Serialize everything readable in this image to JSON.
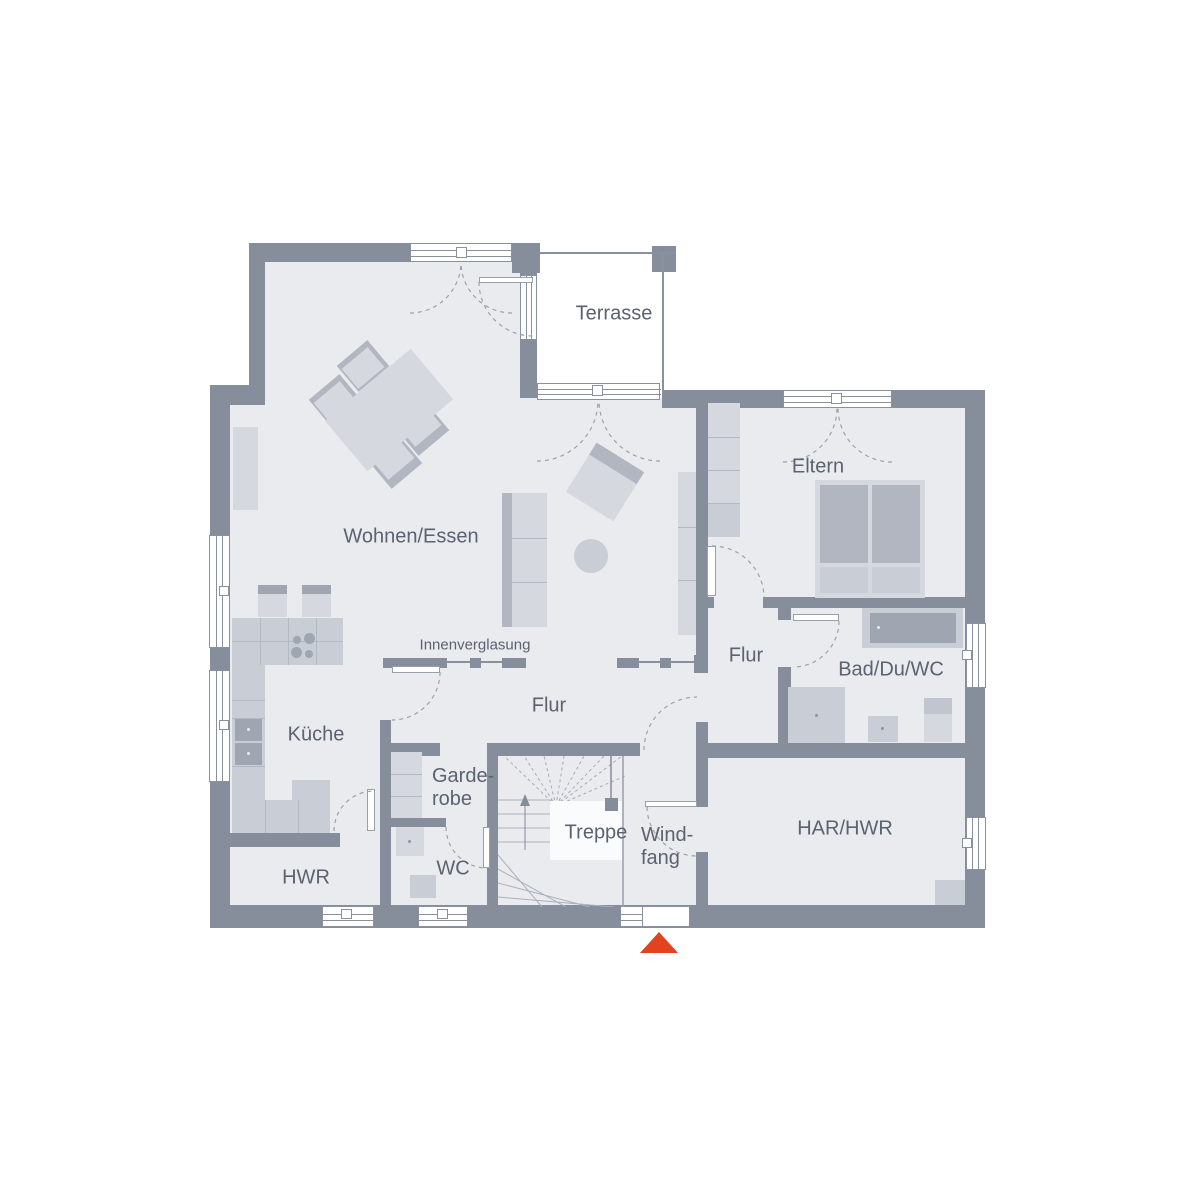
{
  "plan": {
    "rooms": {
      "wohnen_essen": "Wohnen/Essen",
      "terrasse": "Terrasse",
      "eltern": "Eltern",
      "flur_rechts": "Flur",
      "bad_du_wc": "Bad/Du/WC",
      "kueche": "Küche",
      "flur_mitte": "Flur",
      "garderobe": "Garde-\nrobe",
      "hwr": "HWR",
      "wc": "WC",
      "treppe": "Treppe",
      "windfang": "Wind-\nfang",
      "har_hwr": "HAR/HWR"
    },
    "annotations": {
      "innenverglasung": "Innenverglasung"
    },
    "colors": {
      "wall": "#878e9b",
      "floor": "#e9ebef",
      "furniture": "#d5d8df",
      "furniture_mid": "#c9cdd5",
      "furniture_dark": "#b1b6c1",
      "appliance": "#9fa5b1",
      "line": "#8a919e",
      "label_text": "#5b6270",
      "terrace_floor": "#ffffff",
      "entrance_arrow": "#e2431e"
    }
  }
}
